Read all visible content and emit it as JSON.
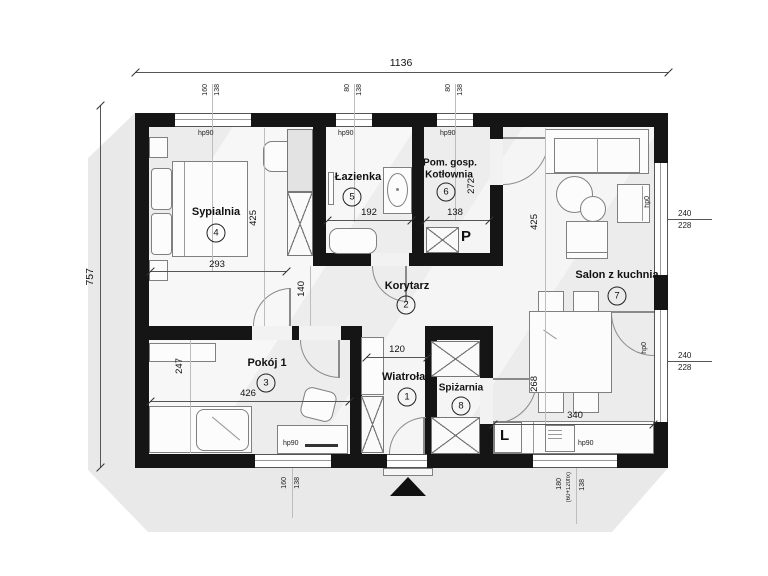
{
  "dimensions": {
    "overall_width": "1136",
    "overall_height": "757",
    "sypialnia_width": "293",
    "sypialnia_height": "425",
    "lazienka_width": "192",
    "kotlownia_width": "138",
    "kotlownia_height": "272",
    "salon_height": "425",
    "korytarz_width": "140",
    "wiatrolap_width": "120",
    "pokoj_width": "426",
    "pokoj_height": "247",
    "kitchen_width": "340",
    "kitchen_height": "268"
  },
  "rooms": [
    {
      "num": "1",
      "name": "Wiatrołap"
    },
    {
      "num": "2",
      "name": "Korytarz"
    },
    {
      "num": "3",
      "name": "Pokój 1"
    },
    {
      "num": "4",
      "name": "Sypialnia"
    },
    {
      "num": "5",
      "name": "Łazienka"
    },
    {
      "num": "6",
      "name_line1": "Pom. gosp.",
      "name_line2": "Kotłownia"
    },
    {
      "num": "7",
      "name": "Salon z kuchnią"
    },
    {
      "num": "8",
      "name": "Spiżarnia"
    }
  ],
  "windows": {
    "top_bedroom": {
      "width": "160",
      "height": "138"
    },
    "top_bathroom": {
      "width": "80",
      "height": "138"
    },
    "top_boiler": {
      "width": "80",
      "height": "138"
    },
    "right_upper": {
      "width": "240",
      "height": "228"
    },
    "right_lower": {
      "width": "240",
      "height": "228"
    },
    "bottom_room": {
      "width": "160",
      "height": "138"
    },
    "bottom_salon": {
      "width": "180",
      "width_note": "(60+120fix)",
      "height": "138"
    }
  },
  "sill_labels": {
    "hp90": "hp90",
    "hp0": "hp0"
  },
  "appliance_marks": {
    "washing_machine": "P",
    "fridge": "L"
  },
  "colors": {
    "wall": "#151515",
    "floor": "#f1f1f1",
    "shadow": "#e9e9e9",
    "dimension_line": "#555555"
  }
}
